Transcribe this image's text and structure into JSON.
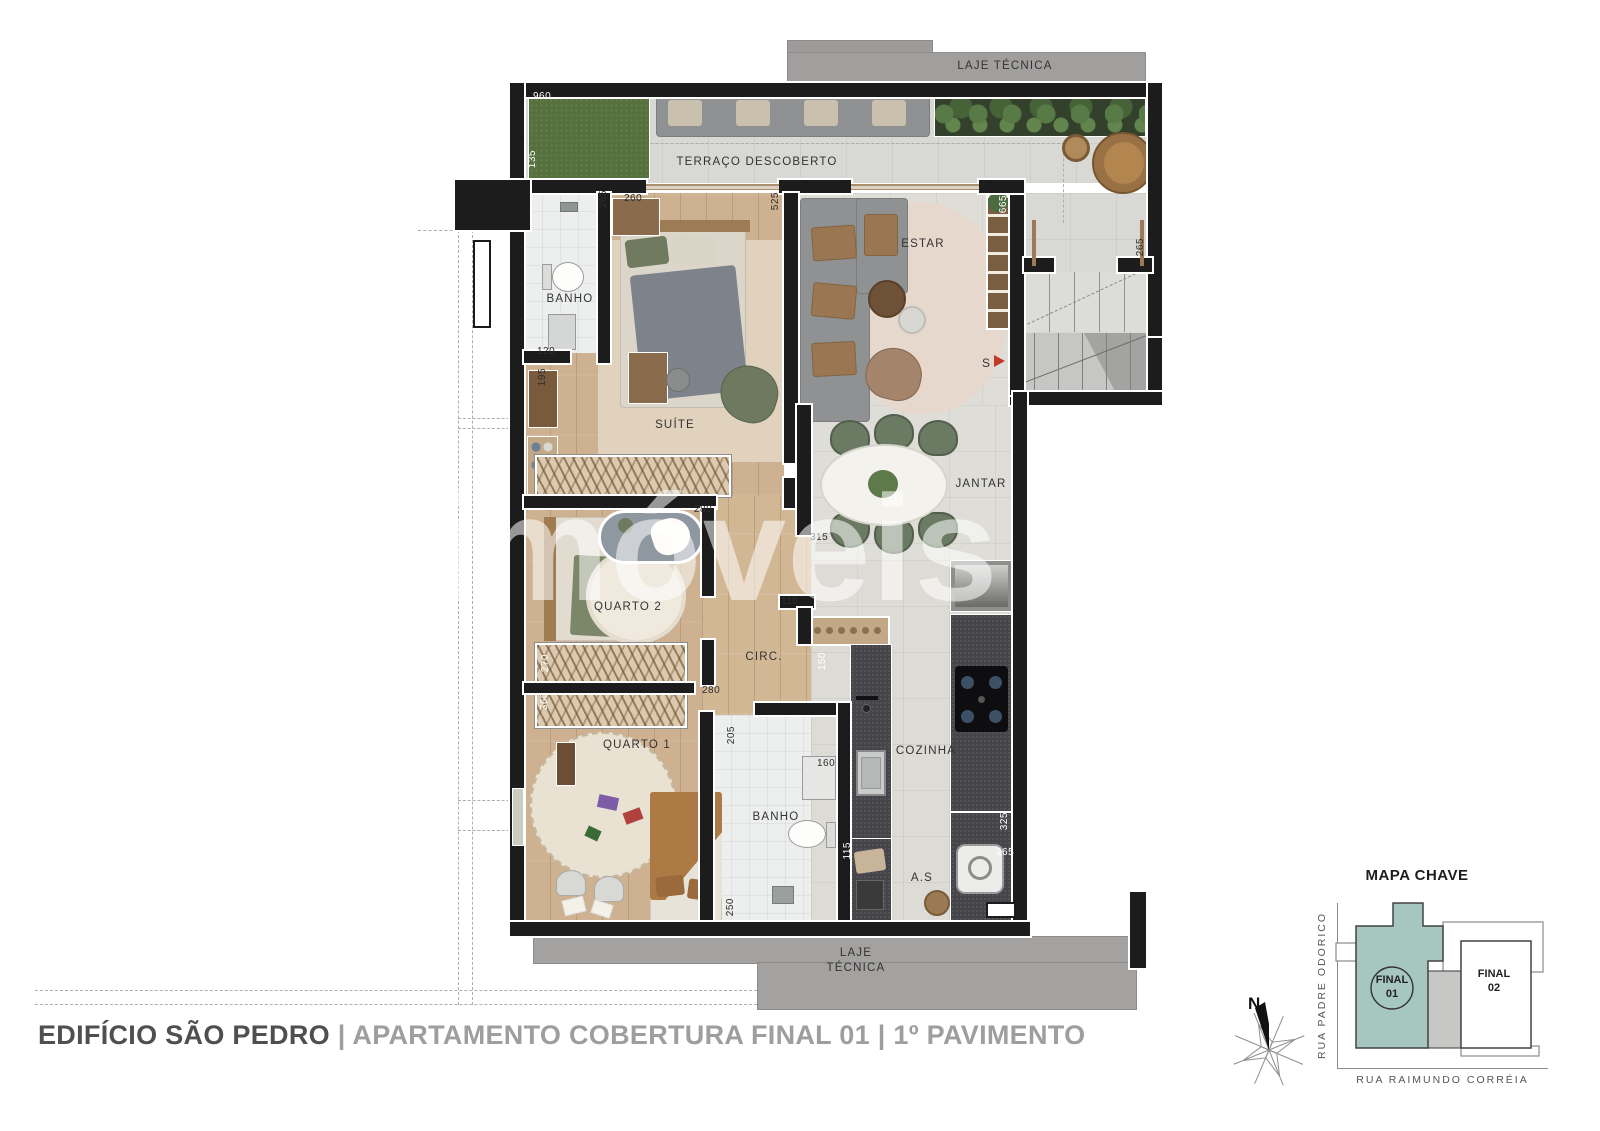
{
  "watermark": "netimóveis",
  "footer": {
    "project": "EDIFÍCIO SÃO PEDRO",
    "sep": " | ",
    "rest": "APARTAMENTO COBERTURA FINAL 01 | 1º PAVIMENTO"
  },
  "plan": {
    "stairs_marker": "S",
    "rooms": [
      {
        "label": "LAJE TÉCNICA",
        "x": 1005,
        "y": 59
      },
      {
        "label": "TERRAÇO DESCOBERTO",
        "x": 757,
        "y": 155
      },
      {
        "label": "BANHO",
        "x": 570,
        "y": 292
      },
      {
        "label": "ESTAR",
        "x": 923,
        "y": 237
      },
      {
        "label": "SUÍTE",
        "x": 675,
        "y": 418
      },
      {
        "label": "JANTAR",
        "x": 981,
        "y": 477
      },
      {
        "label": "QUARTO 2",
        "x": 628,
        "y": 600
      },
      {
        "label": "CIRC.",
        "x": 764,
        "y": 650
      },
      {
        "label": "QUARTO 1",
        "x": 637,
        "y": 738
      },
      {
        "label": "BANHO",
        "x": 776,
        "y": 810
      },
      {
        "label": "COZINHA",
        "x": 926,
        "y": 744
      },
      {
        "label": "A.S",
        "x": 922,
        "y": 871
      },
      {
        "label": "LAJE\nTÉCNICA",
        "x": 856,
        "y": 946
      }
    ],
    "dims": [
      {
        "v": "960",
        "x": 533,
        "y": 92,
        "o": "h",
        "c": "w"
      },
      {
        "v": "135",
        "x": 528,
        "y": 150,
        "o": "v",
        "c": "w"
      },
      {
        "v": "265",
        "x": 599,
        "y": 190,
        "o": "v",
        "c": "d"
      },
      {
        "v": "260",
        "x": 624,
        "y": 194,
        "o": "h",
        "c": "d"
      },
      {
        "v": "525",
        "x": 771,
        "y": 192,
        "o": "v",
        "c": "d"
      },
      {
        "v": "665",
        "x": 999,
        "y": 195,
        "o": "v",
        "c": "w"
      },
      {
        "v": "265",
        "x": 1136,
        "y": 238,
        "o": "v",
        "c": "d"
      },
      {
        "v": "120",
        "x": 537,
        "y": 347,
        "o": "h",
        "c": "d"
      },
      {
        "v": "195",
        "x": 538,
        "y": 368,
        "o": "v",
        "c": "d"
      },
      {
        "v": "280",
        "x": 694,
        "y": 505,
        "o": "h",
        "c": "d"
      },
      {
        "v": "315",
        "x": 810,
        "y": 533,
        "o": "h",
        "c": "d"
      },
      {
        "v": "110",
        "x": 781,
        "y": 597,
        "o": "h",
        "c": "d"
      },
      {
        "v": "270",
        "x": 541,
        "y": 654,
        "o": "v",
        "c": "w"
      },
      {
        "v": "360",
        "x": 540,
        "y": 692,
        "o": "v",
        "c": "w"
      },
      {
        "v": "280",
        "x": 702,
        "y": 686,
        "o": "h",
        "c": "d"
      },
      {
        "v": "150",
        "x": 818,
        "y": 652,
        "o": "v",
        "c": "w"
      },
      {
        "v": "205",
        "x": 727,
        "y": 726,
        "o": "v",
        "c": "d"
      },
      {
        "v": "160",
        "x": 817,
        "y": 759,
        "o": "h",
        "c": "d"
      },
      {
        "v": "115",
        "x": 843,
        "y": 842,
        "o": "v",
        "c": "w"
      },
      {
        "v": "325",
        "x": 1000,
        "y": 812,
        "o": "v",
        "c": "w"
      },
      {
        "v": "265",
        "x": 996,
        "y": 848,
        "o": "h",
        "c": "w"
      },
      {
        "v": "250",
        "x": 726,
        "y": 898,
        "o": "v",
        "c": "d"
      }
    ]
  },
  "key_map": {
    "title": "MAPA CHAVE",
    "street_left": "RUA PADRE ODORICO",
    "street_bottom": "RUA RAIMUNDO CORRÉIA",
    "unit1": "FINAL\n01",
    "unit2": "FINAL\n02",
    "north": "N"
  },
  "colors": {
    "wall": "#1c1c1c",
    "slab": "#a3a2a0",
    "wood": "#cdb190",
    "grass": "#56713e",
    "counter": "#45454a",
    "chair_green": "#6b7a63",
    "accent_teal": "#a6c7bf",
    "red_arrow": "#c0392b"
  }
}
